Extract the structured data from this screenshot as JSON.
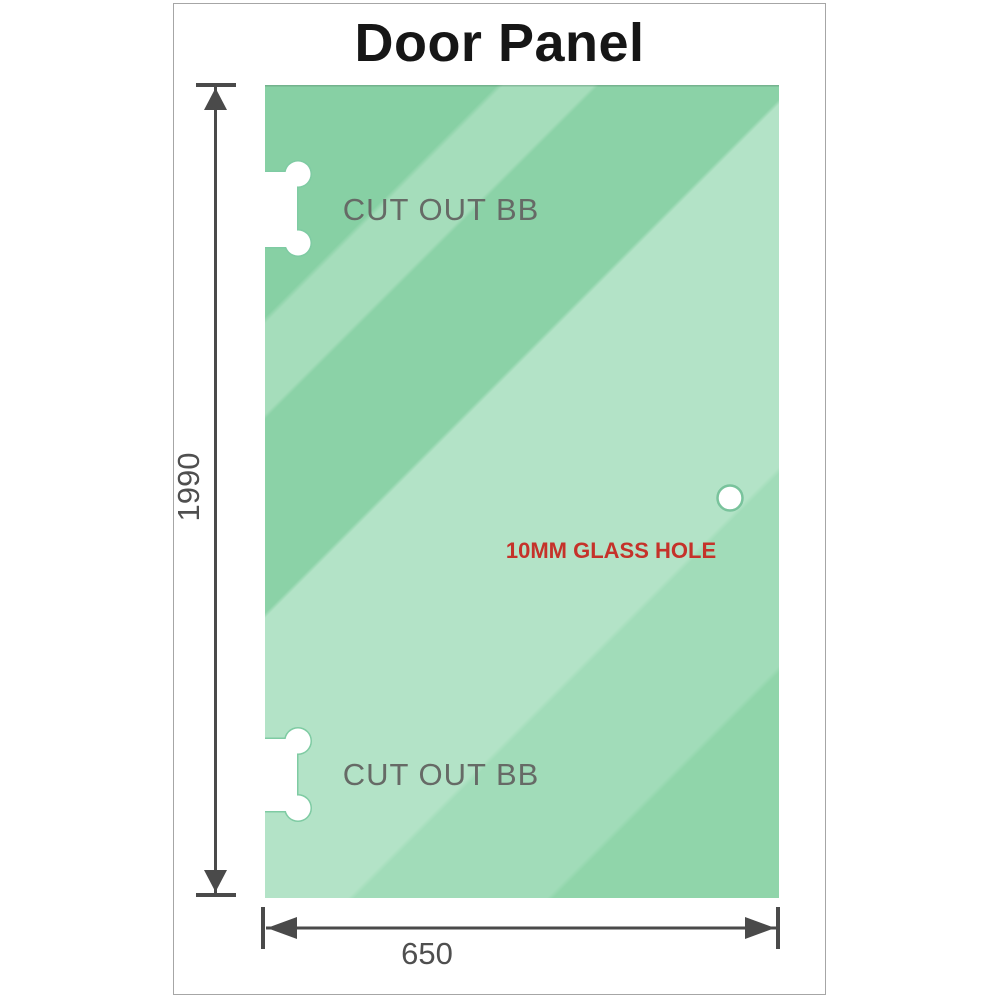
{
  "title": "Door Panel",
  "dimensions": {
    "height": "1990",
    "width": "650"
  },
  "annotations": {
    "cutout_top": "CUT OUT BB",
    "cutout_bottom": "CUT OUT BB",
    "glass_hole": "10MM GLASS HOLE"
  },
  "colors": {
    "glass_base": "#8bd2a7",
    "glass_dark_band": "#87d0a4",
    "glass_light_band": "#b3e3c7",
    "dimension_lines": "#4a4a4a",
    "cutout_label_text": "#666a66",
    "glass_hole_label_text": "#c5322a",
    "title_text": "#161616",
    "frame_border": "#a6a6a6",
    "cutout_fill": "#ffffff",
    "cutout_rim": "#7fcba3"
  }
}
